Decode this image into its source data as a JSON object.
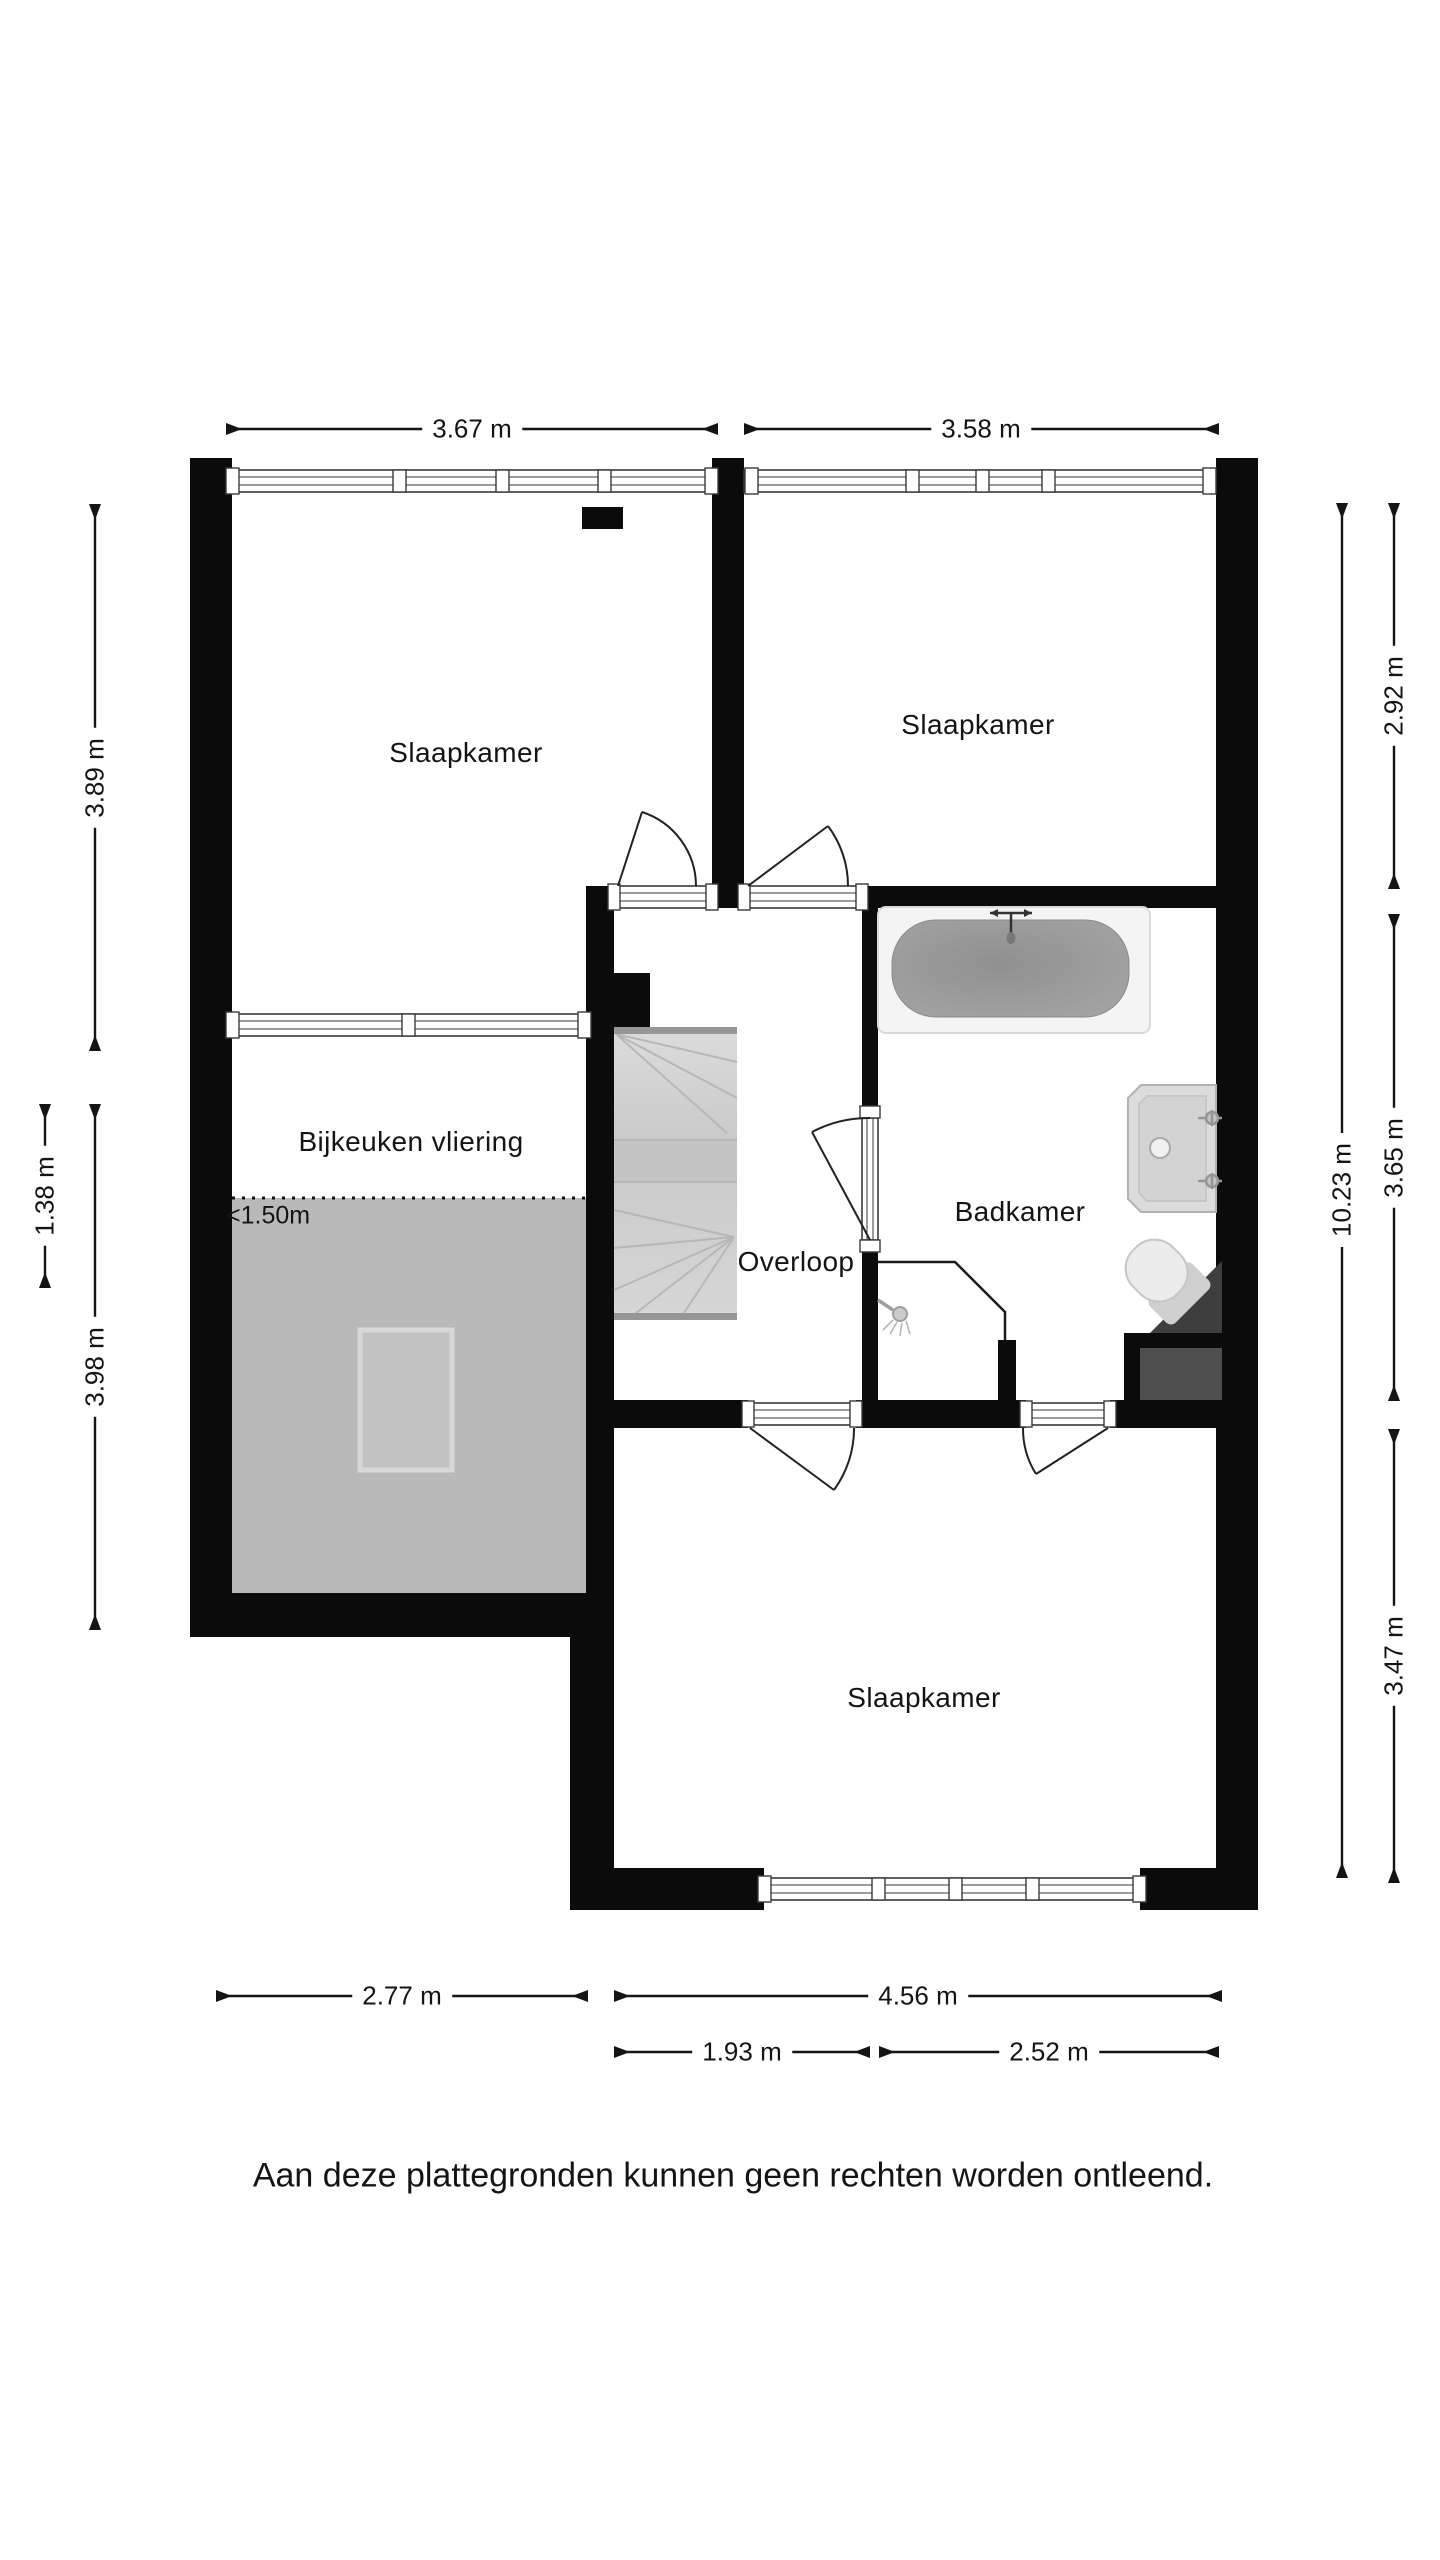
{
  "floorplan": {
    "rooms": {
      "bedroom_top_left": "Slaapkamer",
      "bedroom_top_right": "Slaapkamer",
      "utility_attic": "Bijkeuken vliering",
      "landing": "Overloop",
      "bathroom": "Badkamer",
      "bedroom_bottom": "Slaapkamer",
      "low_height_marker": "<1.50m"
    },
    "dimensions": {
      "top": [
        "3.67 m",
        "3.58 m"
      ],
      "left": [
        "3.89 m",
        "1.38 m",
        "3.98 m"
      ],
      "right": [
        "10.23 m",
        "2.92 m",
        "3.65 m",
        "3.47 m"
      ],
      "bottom": [
        "2.77 m",
        "4.56 m",
        "1.93 m",
        "2.52 m"
      ]
    },
    "disclaimer": "Aan deze plattegronden kunnen geen rechten worden ontleend.",
    "objects": [
      "staircase",
      "bathtub",
      "washbasin",
      "toilet",
      "shower-head",
      "skylight",
      "chimney"
    ],
    "colors": {
      "wall": "#0b0b0b",
      "lowarea": "#b9b9b9",
      "stairs": "#d2d2d2",
      "tub": "#9c9c9c",
      "alcove": "#4e4e4e",
      "cistern": "#3e3e3e"
    }
  }
}
